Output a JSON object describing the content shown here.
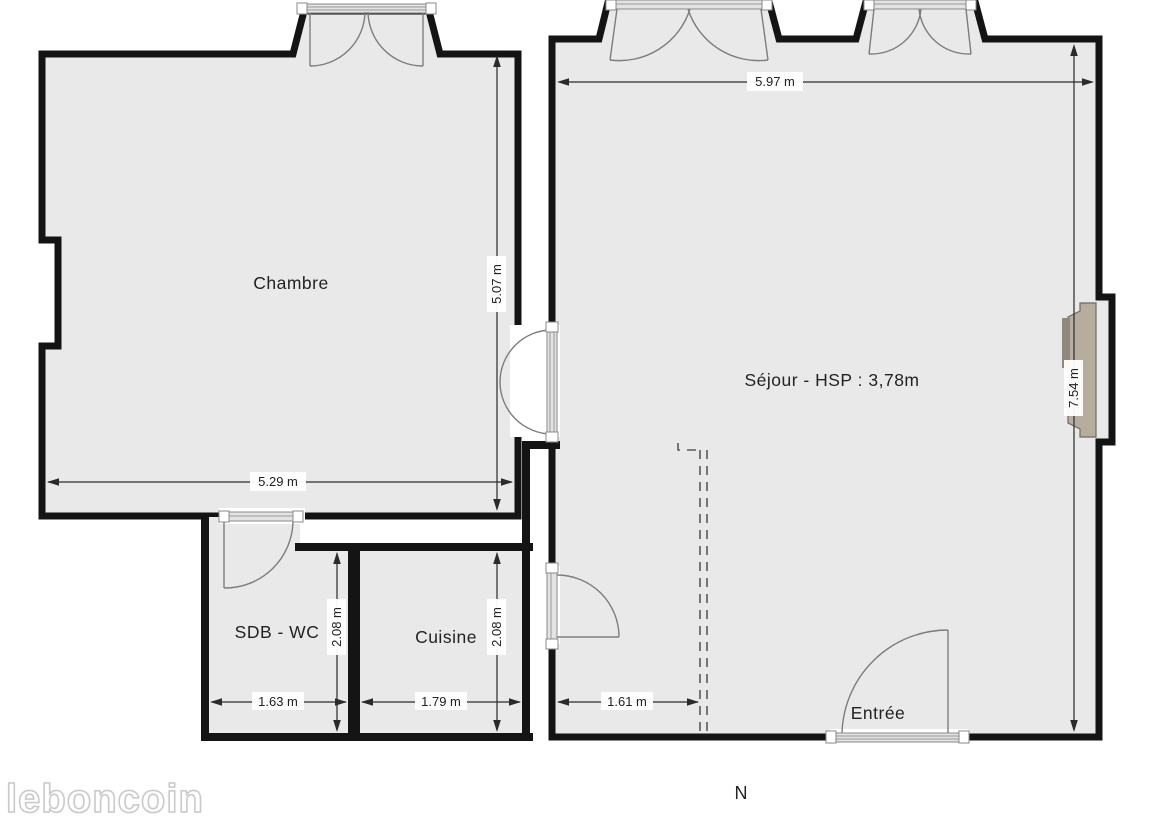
{
  "plan": {
    "labels": {
      "chambre": "Chambre",
      "sejour": "Séjour - HSP : 3,78m",
      "sdb": "SDB - WC",
      "cuisine": "Cuisine",
      "entree": "Entrée"
    },
    "dims": {
      "sejour_w": "5.97 m",
      "chambre_h": "5.07 m",
      "chambre_w": "5.29 m",
      "sejour_h": "7.54 m",
      "sdb_h": "2.08 m",
      "cuisine_h": "2.08 m",
      "sdb_w": "1.63 m",
      "cuisine_w": "1.79 m",
      "sejour_lw": "1.61 m"
    },
    "compass": {
      "north": "N"
    },
    "watermark": {
      "text": "leboncoin"
    },
    "colors": {
      "room_fill": "#e9e9e9",
      "wall": "#141414",
      "fireplace": "#b7ad9e",
      "dimension": "#2b2b2b"
    }
  }
}
